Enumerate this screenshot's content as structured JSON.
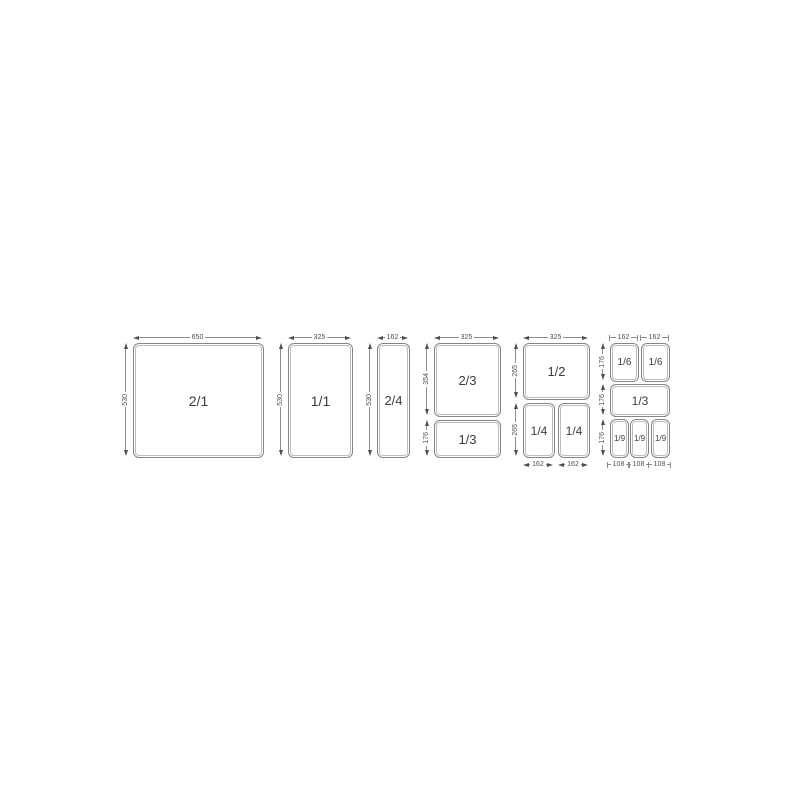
{
  "diagram": {
    "name": "gastronorm-pan-size-chart",
    "line_color": "#8c8c8c",
    "text_color": "#3c3c3c",
    "groups": [
      {
        "id": "gn-2-1",
        "top_dims": [
          "650"
        ],
        "left_dims": [
          "530"
        ],
        "bottom_dims": [],
        "pans": [
          "2/1"
        ]
      },
      {
        "id": "gn-1-1",
        "top_dims": [
          "325"
        ],
        "left_dims": [
          "530"
        ],
        "bottom_dims": [],
        "pans": [
          "1/1"
        ]
      },
      {
        "id": "gn-2-4",
        "top_dims": [
          "162"
        ],
        "left_dims": [
          "530"
        ],
        "bottom_dims": [],
        "pans": [
          "2/4"
        ]
      },
      {
        "id": "gn-2-3-plus-1-3",
        "top_dims": [
          "325"
        ],
        "left_dims": [
          "354",
          "176"
        ],
        "bottom_dims": [],
        "pans": [
          "2/3",
          "1/3"
        ]
      },
      {
        "id": "gn-1-2-plus-1-4",
        "top_dims": [
          "325"
        ],
        "left_dims": [
          "265",
          "265"
        ],
        "bottom_dims": [
          "162",
          "162"
        ],
        "pans": [
          "1/2",
          "1/4",
          "1/4"
        ]
      },
      {
        "id": "gn-1-6-1-3-1-9",
        "top_dims": [
          "162",
          "162"
        ],
        "left_dims": [
          "176",
          "176",
          "176"
        ],
        "bottom_dims": [
          "108",
          "108",
          "108"
        ],
        "pans": [
          "1/6",
          "1/6",
          "1/3",
          "1/9",
          "1/9",
          "1/9"
        ]
      }
    ]
  }
}
